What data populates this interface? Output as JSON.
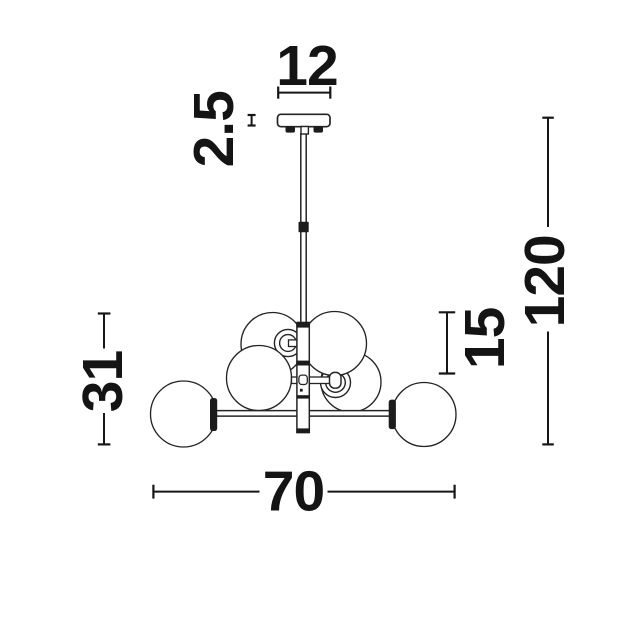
{
  "drawing": {
    "kind": "chandelier-technical-dimension-drawing",
    "background": "#ffffff",
    "line_color": "#242424",
    "label_color": "#141414",
    "labels": {
      "canopy_width": "12",
      "canopy_height": "2.5",
      "overall_height": "120",
      "globe_diameter": "15",
      "cluster_height": "31",
      "overall_width": "70"
    }
  }
}
